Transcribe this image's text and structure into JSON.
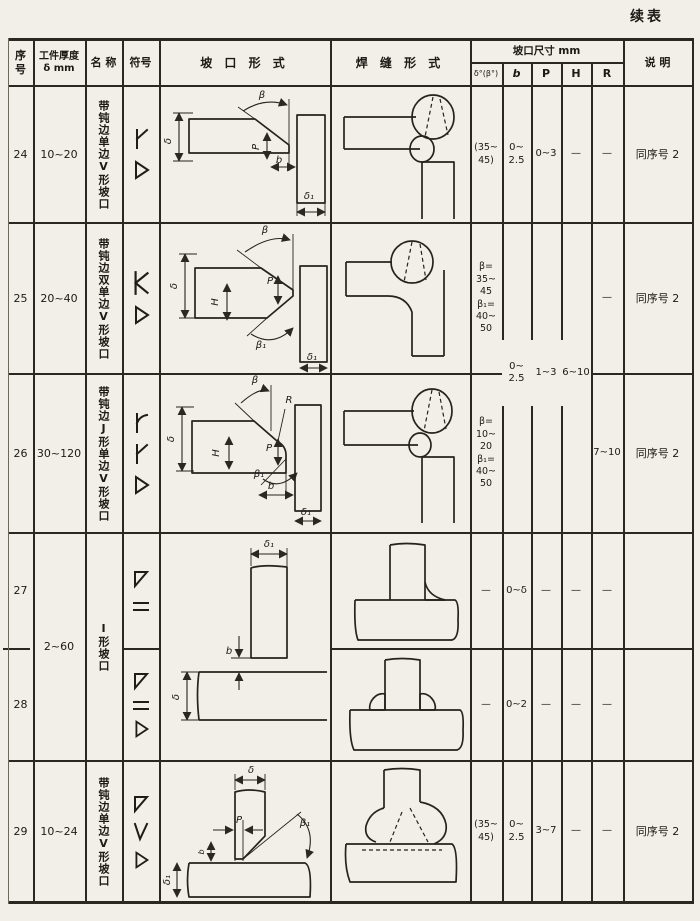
{
  "colors": {
    "paper": "#f2efe8",
    "ink": "#1d1a16",
    "line": "#2b2721"
  },
  "page": {
    "continued_label": "续表"
  },
  "header": {
    "no": "序\n号",
    "thickness": "工件厚度\nδ mm",
    "name": "名 称",
    "symbol": "符号",
    "groove": "坡 口 形 式",
    "weld": "焊 缝 形 式",
    "dims_group": "坡口尺寸 mm",
    "dim_angle": "δ°(β°)",
    "dim_b": "b",
    "dim_p": "P",
    "dim_h": "H",
    "dim_r": "R",
    "note": "说 明"
  },
  "rows": [
    {
      "no": "24",
      "thickness": "10~20",
      "name": "带钝边单边V形坡口",
      "symbols": [
        "single-bevel-with-root-face",
        "fillet"
      ],
      "labels": {
        "beta": "β",
        "delta": "δ",
        "p": "P",
        "b": "b",
        "delta1": "δ₁"
      },
      "dims": {
        "angle": "(35~\n45)",
        "b": "0~\n2.5",
        "p": "0~3",
        "h": "—",
        "r": "—"
      },
      "note": "同序号 2"
    },
    {
      "no": "25",
      "thickness": "20~40",
      "name": "带钝边双单边V形坡口",
      "symbols": [
        "double-bevel-K",
        "fillet"
      ],
      "labels": {
        "beta": "β",
        "delta": "δ",
        "h": "H",
        "p": "P",
        "beta1": "β₁",
        "delta1": "δ₁"
      },
      "dims": {
        "angle": "β=\n35~\n45\nβ₁=\n40~\n50",
        "r": "—"
      },
      "note": "同序号 2"
    },
    {
      "no": "26",
      "thickness": "30~120",
      "name": "带钝边J形单边V形坡口",
      "symbols": [
        "j-groove",
        "single-bevel-with-root-face",
        "fillet"
      ],
      "labels": {
        "beta": "β",
        "r": "R",
        "delta": "δ",
        "h": "H",
        "p": "P",
        "beta1": "β₁",
        "b": "b",
        "delta1": "δ₁"
      },
      "dims": {
        "angle": "β=\n10~\n20\nβ₁=\n40~\n50",
        "r": "7~10"
      },
      "note": "同序号 2"
    },
    {
      "no": "27",
      "symbols": [
        "triangle",
        "square-groove"
      ],
      "dims": {
        "angle": "—",
        "b": "0~δ",
        "p": "—",
        "h": "—",
        "r": "—"
      },
      "note": ""
    },
    {
      "no": "28",
      "symbols": [
        "triangle",
        "square-groove",
        "fillet"
      ],
      "dims": {
        "angle": "—",
        "b": "0~2",
        "p": "—",
        "h": "—",
        "r": "—"
      },
      "note": ""
    },
    {
      "no": "29",
      "thickness": "10~24",
      "name": "带钝边单边V形坡口",
      "symbols": [
        "triangle",
        "single-V",
        "fillet"
      ],
      "labels": {
        "delta": "δ",
        "p": "P",
        "beta1": "β₁",
        "b": "b",
        "delta1": "δ₁"
      },
      "dims": {
        "angle": "(35~\n45)",
        "b": "0~\n2.5",
        "p": "3~7",
        "h": "—",
        "r": "—"
      },
      "note": "同序号 2"
    }
  ],
  "merged": {
    "thickness_27_28": "2~60",
    "name_27_28": "I形坡口",
    "b_25_26": "0~\n2.5",
    "p_25_26": "1~3",
    "h_25_26": "6~10",
    "groove_27_28_labels": {
      "delta1": "δ₁",
      "b": "b",
      "delta": "δ"
    }
  }
}
